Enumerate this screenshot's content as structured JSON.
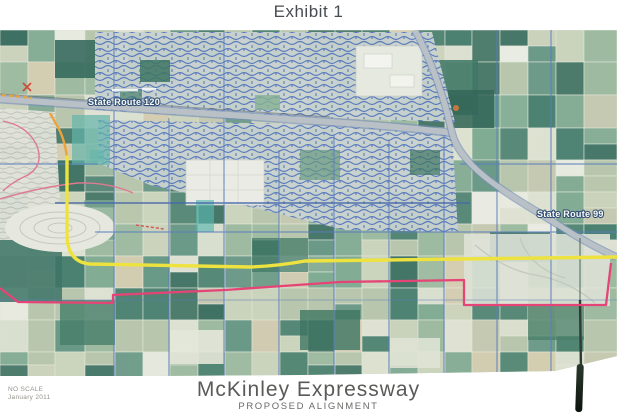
{
  "page": {
    "exhibit_title": "Exhibit 1"
  },
  "map": {
    "labels": {
      "route_120": "State Route 120",
      "route_99": "State Route 99"
    },
    "colors": {
      "proposed_alignment_yellow": "#f2e52f",
      "alternate_alignment_pink": "#e8356e",
      "study_boundary_red": "#e0708c",
      "connector_orange": "#ef9f2e",
      "urban_street_blue": "#4a6fc0",
      "farmland_green": "#3d7868"
    }
  },
  "footer": {
    "scale_note": "NO SCALE",
    "date": "January 2011",
    "project_title": "McKinley Expressway",
    "project_subtitle": "PROPOSED ALIGNMENT"
  }
}
